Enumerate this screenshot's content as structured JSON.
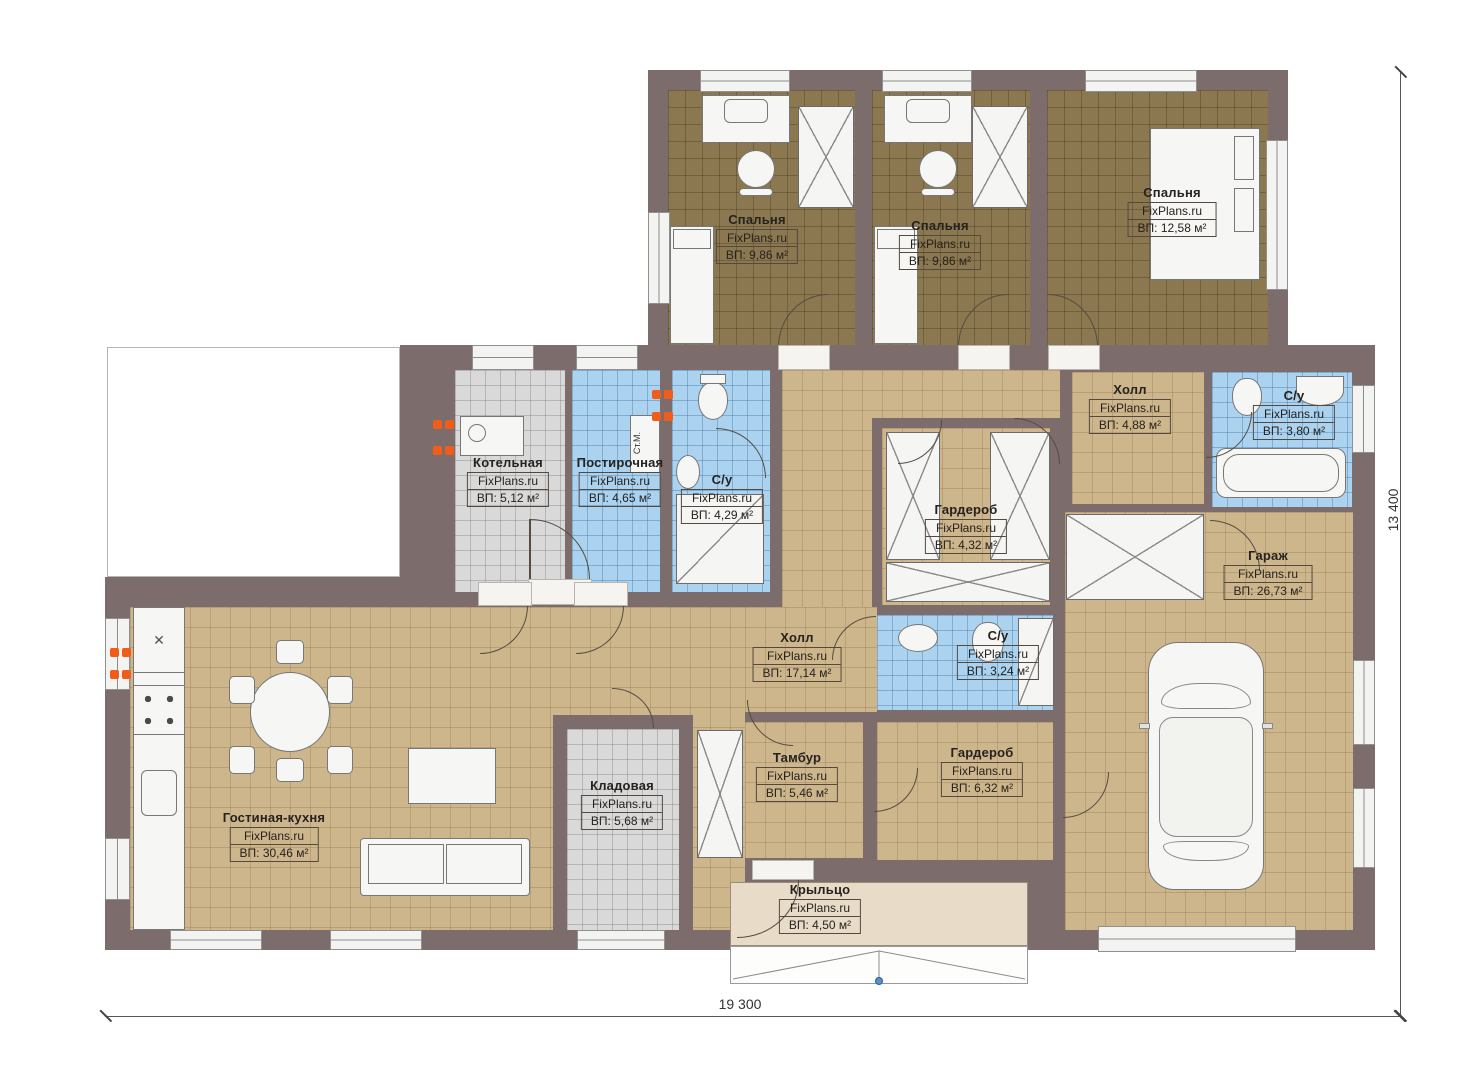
{
  "plan": {
    "title": "Одноэтажный дом — план этажа",
    "source_watermark": "FixPlans.ru"
  },
  "rooms": [
    {
      "name": "Спальня",
      "watermark": "FixPlans.ru",
      "area": "ВП: 9,86 м²"
    },
    {
      "name": "Спальня",
      "watermark": "FixPlans.ru",
      "area": "ВП: 9,86 м²"
    },
    {
      "name": "Спальня",
      "watermark": "FixPlans.ru",
      "area": "ВП: 12,58 м²"
    },
    {
      "name": "Котельная",
      "watermark": "FixPlans.ru",
      "area": "ВП: 5,12 м²"
    },
    {
      "name": "Постирочная",
      "watermark": "FixPlans.ru",
      "area": "ВП: 4,65 м²"
    },
    {
      "name": "С/у",
      "watermark": "FixPlans.ru",
      "area": "ВП: 4,29 м²"
    },
    {
      "name": "Холл",
      "watermark": "FixPlans.ru",
      "area": "ВП: 4,88 м²"
    },
    {
      "name": "С/у",
      "watermark": "FixPlans.ru",
      "area": "ВП: 3,80 м²"
    },
    {
      "name": "Гардероб",
      "watermark": "FixPlans.ru",
      "area": "ВП: 4,32 м²"
    },
    {
      "name": "Гараж",
      "watermark": "FixPlans.ru",
      "area": "ВП: 26,73 м²"
    },
    {
      "name": "Холл",
      "watermark": "FixPlans.ru",
      "area": "ВП: 17,14 м²"
    },
    {
      "name": "С/у",
      "watermark": "FixPlans.ru",
      "area": "ВП: 3,24 м²"
    },
    {
      "name": "Тамбур",
      "watermark": "FixPlans.ru",
      "area": "ВП: 5,46 м²"
    },
    {
      "name": "Гардероб",
      "watermark": "FixPlans.ru",
      "area": "ВП: 6,32 м²"
    },
    {
      "name": "Кладовая",
      "watermark": "FixPlans.ru",
      "area": "ВП: 5,68 м²"
    },
    {
      "name": "Гостиная-кухня",
      "watermark": "FixPlans.ru",
      "area": "ВП: 30,46 м²"
    },
    {
      "name": "Крыльцо",
      "watermark": "FixPlans.ru",
      "area": "ВП: 4,50 м²"
    }
  ],
  "labels": {
    "washing_machine": "Ст.М."
  },
  "dimensions": {
    "width": "19 300",
    "height": "13 400"
  },
  "colors": {
    "wall": "#7d6c6c",
    "tile_tan": "#cdb68c",
    "tile_blue": "#abd3f0",
    "tile_gray": "#d9d9d9",
    "carpet_olive": "#8c7850",
    "porch": "#e8dcc8",
    "vent_orange": "#f25c19"
  }
}
